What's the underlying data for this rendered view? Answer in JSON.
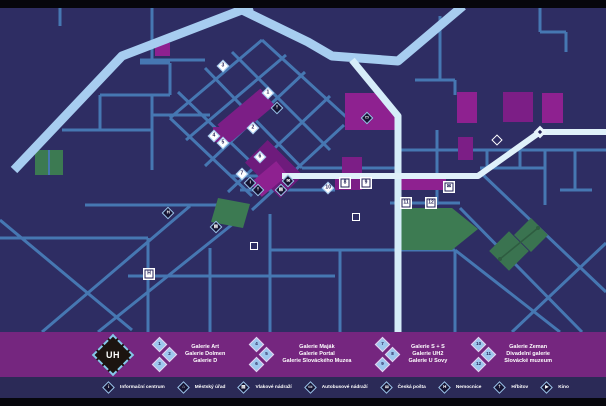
{
  "legend": {
    "logo": "UH",
    "groups": [
      {
        "items": [
          {
            "n": "1",
            "label": "Galerie Art"
          },
          {
            "n": "2",
            "label": "Galerie Dolmen"
          },
          {
            "n": "3",
            "label": "Galerie D"
          }
        ]
      },
      {
        "items": [
          {
            "n": "4",
            "label": "Galerie Maják"
          },
          {
            "n": "5",
            "label": "Galerie Portal"
          },
          {
            "n": "6",
            "label": "Galerie Slováckého Muzea"
          }
        ]
      },
      {
        "items": [
          {
            "n": "7",
            "label": "Galerie S + S"
          },
          {
            "n": "8",
            "label": "Galerie UH2"
          },
          {
            "n": "9",
            "label": "Galerie U Sovy"
          }
        ]
      },
      {
        "items": [
          {
            "n": "10",
            "label": "Galerie Zeman"
          },
          {
            "n": "11",
            "label": "Divadelní galerie"
          },
          {
            "n": "12",
            "label": "Slovácké muzeum"
          }
        ]
      }
    ]
  },
  "amenities": [
    {
      "icon": "info-icon",
      "glyph": "i",
      "label": "Informační centrum"
    },
    {
      "icon": "town-hall-icon",
      "glyph": "⌂",
      "label": "Městský úřad"
    },
    {
      "icon": "train-icon",
      "glyph": "▤",
      "label": "Vlakové nádraží"
    },
    {
      "icon": "bus-icon",
      "glyph": "▭",
      "label": "Autobusové nádraží"
    },
    {
      "icon": "post-icon",
      "glyph": "✉",
      "label": "Česká pošta"
    },
    {
      "icon": "hospital-icon",
      "glyph": "H",
      "label": "Nemocnice"
    },
    {
      "icon": "cemetery-icon",
      "glyph": "†",
      "label": "Hřbitov"
    },
    {
      "icon": "cinema-icon",
      "glyph": "▶",
      "label": "Kino"
    }
  ],
  "map": {
    "markers": [
      {
        "kind": "dnum",
        "label": "3",
        "x": 223,
        "y": 66
      },
      {
        "kind": "dnum",
        "label": "1",
        "x": 268,
        "y": 93
      },
      {
        "kind": "dicon",
        "glyph": "†",
        "icon": "church-icon",
        "x": 277,
        "y": 108
      },
      {
        "kind": "dnum",
        "label": "2",
        "x": 253,
        "y": 128
      },
      {
        "kind": "dnum",
        "label": "4",
        "x": 214,
        "y": 136
      },
      {
        "kind": "dnum",
        "label": "5",
        "x": 223,
        "y": 143
      },
      {
        "kind": "dnum",
        "label": "6",
        "x": 260,
        "y": 157
      },
      {
        "kind": "dnum",
        "label": "7",
        "x": 242,
        "y": 174
      },
      {
        "kind": "dnum",
        "label": "10",
        "x": 328,
        "y": 188
      },
      {
        "kind": "dicon",
        "glyph": "i",
        "icon": "info-icon",
        "x": 250,
        "y": 183
      },
      {
        "kind": "dicon",
        "glyph": "†",
        "icon": "cemetery-icon",
        "x": 258,
        "y": 190
      },
      {
        "kind": "dicon",
        "glyph": "✉",
        "icon": "post-icon",
        "x": 288,
        "y": 181
      },
      {
        "kind": "dicon",
        "glyph": "▤",
        "icon": "train-icon",
        "x": 281,
        "y": 190
      },
      {
        "kind": "dicon",
        "glyph": "▭",
        "icon": "bus-icon",
        "x": 367,
        "y": 118
      },
      {
        "kind": "dicon",
        "glyph": "▤",
        "icon": "train-icon",
        "x": 216,
        "y": 227
      },
      {
        "kind": "dicon",
        "glyph": "H",
        "icon": "hospital-icon",
        "x": 168,
        "y": 213
      },
      {
        "kind": "sicon",
        "glyph": "H",
        "icon": "hospital-icon",
        "x": 149,
        "y": 274
      },
      {
        "kind": "snum",
        "label": "8",
        "x": 345,
        "y": 183
      },
      {
        "kind": "snum",
        "label": "9",
        "x": 366,
        "y": 183
      },
      {
        "kind": "sicon",
        "glyph": "✉",
        "icon": "post-icon",
        "x": 449,
        "y": 187
      },
      {
        "kind": "snum",
        "label": "11",
        "x": 406,
        "y": 203
      },
      {
        "kind": "snum",
        "label": "12",
        "x": 431,
        "y": 203
      },
      {
        "kind": "dout",
        "x": 497,
        "y": 140
      },
      {
        "kind": "djct",
        "x": 540,
        "y": 132
      },
      {
        "kind": "sout",
        "x": 254,
        "y": 246
      },
      {
        "kind": "sout",
        "x": 356,
        "y": 217
      }
    ]
  },
  "colors": {
    "frame": "#06060c",
    "map_background": "#2e2d63",
    "road_minor": "#4677b2",
    "road_major": "#a7cdf0",
    "river": "#d6edf9",
    "building": "#8e2190",
    "building_dark": "#6e1b7c",
    "park": "#3c7a52",
    "legend_bar": "#75267f",
    "footer_bar": "#2b2a57"
  }
}
